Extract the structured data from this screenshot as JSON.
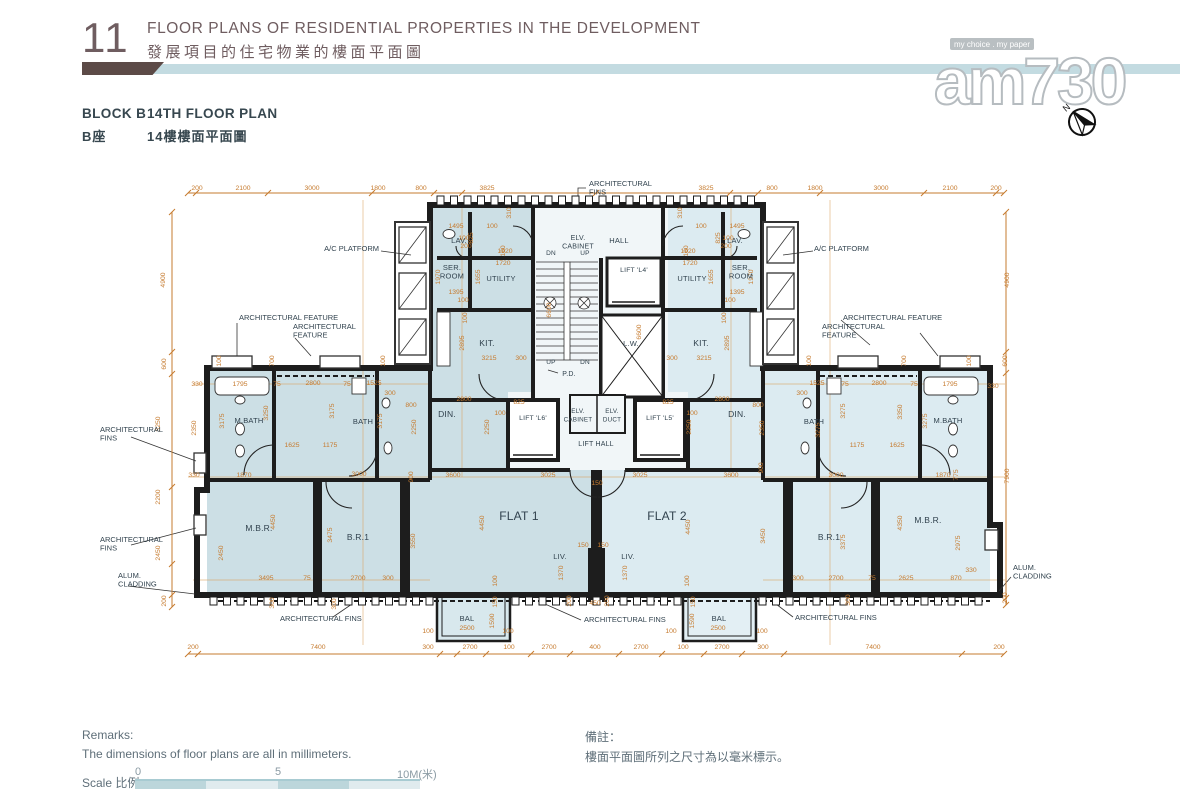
{
  "page": {
    "section_number": "11",
    "title_en": "FLOOR PLANS OF RESIDENTIAL PROPERTIES IN THE DEVELOPMENT",
    "title_zh": "發展項目的住宅物業的樓面平面圖",
    "block_label_en": "BLOCK B",
    "block_label_zh": "B座",
    "plan_label_en": "14TH FLOOR PLAN",
    "plan_label_zh": "14樓樓面平面圖"
  },
  "watermark": {
    "logo_text": "am730",
    "tagline": "my choice . my paper",
    "compass_letter": "N"
  },
  "remarks": {
    "en_title": "Remarks:",
    "en_text": "The dimensions of floor plans are all in millimeters.",
    "zh_title": "備註：",
    "zh_text": "樓面平面圖所列之尺寸為以毫米標示。"
  },
  "scale": {
    "label": "Scale 比例 :",
    "ticks": [
      "0",
      "5",
      "10M(米)"
    ]
  },
  "colors": {
    "dimension_orange": "#c67b2f",
    "wall": "#1d1d1d",
    "flat1_fill": "#ccdfe5",
    "flat2_fill": "#dcebf1",
    "common_fill": "#f1f6f8",
    "header_brown": "#6f5d60",
    "divider_blue": "#c3dbe1",
    "divider_brown": "#5c4a47",
    "label_blue": "#31424e"
  },
  "plan": {
    "flats": [
      "FLAT 1",
      "FLAT 2"
    ],
    "rooms": [
      {
        "t": "LAV.",
        "x": 459,
        "y": 243,
        "fs": 7.5
      },
      {
        "t": "LAV.",
        "x": 735,
        "y": 243,
        "fs": 7.5
      },
      {
        "lines": [
          "SER.",
          "ROOM"
        ],
        "x": 452,
        "y": 270,
        "fs": 7.5
      },
      {
        "lines": [
          "SER.",
          "ROOM"
        ],
        "x": 741,
        "y": 270,
        "fs": 7.5
      },
      {
        "t": "UTILITY",
        "x": 501,
        "y": 281,
        "fs": 7.5
      },
      {
        "t": "UTILITY",
        "x": 692,
        "y": 281,
        "fs": 7.5
      },
      {
        "lines": [
          "ELV.",
          "CABINET"
        ],
        "x": 578,
        "y": 240,
        "fs": 7
      },
      {
        "t": "HALL",
        "x": 619,
        "y": 243,
        "fs": 7.5
      },
      {
        "t": "DN",
        "x": 551,
        "y": 255,
        "fs": 6.5
      },
      {
        "t": "UP",
        "x": 585,
        "y": 255,
        "fs": 6.5
      },
      {
        "t": "UP",
        "x": 551,
        "y": 364,
        "fs": 6.5
      },
      {
        "t": "DN",
        "x": 585,
        "y": 364,
        "fs": 6.5
      },
      {
        "t": "LIFT 'L4'",
        "x": 634,
        "y": 272,
        "fs": 6.8
      },
      {
        "t": "L.W.",
        "x": 631,
        "y": 346,
        "fs": 7.5
      },
      {
        "t": "P.D.",
        "x": 569,
        "y": 376,
        "fs": 7
      },
      {
        "t": "KIT.",
        "x": 487,
        "y": 346
      },
      {
        "t": "KIT.",
        "x": 701,
        "y": 346
      },
      {
        "t": "LIFT 'L6'",
        "x": 533,
        "y": 420,
        "fs": 6.8
      },
      {
        "t": "LIFT 'L5'",
        "x": 660,
        "y": 420,
        "fs": 6.8
      },
      {
        "lines": [
          "ELV.",
          "CABINET"
        ],
        "x": 578,
        "y": 413,
        "fs": 6.3
      },
      {
        "lines": [
          "ELV.",
          "DUCT"
        ],
        "x": 612,
        "y": 413,
        "fs": 6.3
      },
      {
        "t": "LIFT HALL",
        "x": 596,
        "y": 446,
        "fs": 7
      },
      {
        "t": "DIN.",
        "x": 447,
        "y": 417
      },
      {
        "t": "DIN.",
        "x": 737,
        "y": 417
      },
      {
        "t": "M.BATH",
        "x": 249,
        "y": 423,
        "fs": 7.5
      },
      {
        "t": "BATH",
        "x": 363,
        "y": 424,
        "fs": 7.5
      },
      {
        "t": "BATH",
        "x": 814,
        "y": 424,
        "fs": 7.5
      },
      {
        "t": "M.BATH",
        "x": 948,
        "y": 423,
        "fs": 7.5
      },
      {
        "t": "M.B.R.",
        "x": 259,
        "y": 531
      },
      {
        "t": "B.R.1",
        "x": 358,
        "y": 540
      },
      {
        "t": "B.R.1",
        "x": 829,
        "y": 540
      },
      {
        "t": "M.B.R.",
        "x": 928,
        "y": 523
      },
      {
        "t": "FLAT 1",
        "x": 519,
        "y": 520,
        "fs": 12
      },
      {
        "t": "FLAT 2",
        "x": 667,
        "y": 520,
        "fs": 12
      },
      {
        "t": "LIV.",
        "x": 560,
        "y": 559,
        "fs": 7.5
      },
      {
        "t": "LIV.",
        "x": 628,
        "y": 559,
        "fs": 7.5
      },
      {
        "t": "BAL",
        "x": 467,
        "y": 621,
        "fs": 7.5
      },
      {
        "t": "BAL",
        "x": 719,
        "y": 621,
        "fs": 7.5
      }
    ],
    "annotations": [
      {
        "lines": [
          "ARCHITECTURAL",
          "FINS"
        ],
        "x": 589,
        "y": 186,
        "a": "start"
      },
      {
        "t": "A/C PLATFORM",
        "x": 379,
        "y": 251,
        "a": "end"
      },
      {
        "t": "A/C PLATFORM",
        "x": 814,
        "y": 251,
        "a": "start"
      },
      {
        "t": "ARCHITECTURAL FEATURE",
        "x": 239,
        "y": 320,
        "a": "start"
      },
      {
        "lines": [
          "ARCHITECTURAL",
          "FEATURE"
        ],
        "x": 293,
        "y": 329,
        "a": "start"
      },
      {
        "t": "ARCHITECTURAL FEATURE",
        "x": 843,
        "y": 320,
        "a": "start"
      },
      {
        "lines": [
          "ARCHITECTURAL",
          "FEATURE"
        ],
        "x": 822,
        "y": 329,
        "a": "start"
      },
      {
        "lines": [
          "ARCHITECTURAL",
          "FINS"
        ],
        "x": 100,
        "y": 432,
        "a": "start"
      },
      {
        "lines": [
          "ARCHITECTURAL",
          "FINS"
        ],
        "x": 100,
        "y": 542,
        "a": "start"
      },
      {
        "lines": [
          "ALUM.",
          "CLADDING"
        ],
        "x": 118,
        "y": 578,
        "a": "start"
      },
      {
        "lines": [
          "ALUM.",
          "CLADDING"
        ],
        "x": 1013,
        "y": 570,
        "a": "start"
      },
      {
        "t": "ARCHITECTURAL FINS",
        "x": 280,
        "y": 621,
        "a": "start"
      },
      {
        "t": "ARCHITECTURAL FINS",
        "x": 584,
        "y": 622,
        "a": "start"
      },
      {
        "t": "ARCHITECTURAL FINS",
        "x": 795,
        "y": 620,
        "a": "start"
      }
    ],
    "dims_h": [
      [
        200,
        197,
        190
      ],
      [
        2100,
        243,
        190
      ],
      [
        3000,
        312,
        190
      ],
      [
        1800,
        378,
        190
      ],
      [
        800,
        421,
        190
      ],
      [
        3825,
        487,
        190
      ],
      [
        3825,
        706,
        190
      ],
      [
        800,
        772,
        190
      ],
      [
        1800,
        815,
        190
      ],
      [
        3000,
        881,
        190
      ],
      [
        2100,
        950,
        190
      ],
      [
        200,
        996,
        190
      ],
      [
        200,
        193,
        649
      ],
      [
        7400,
        318,
        649
      ],
      [
        300,
        428,
        649
      ],
      [
        2700,
        470,
        649
      ],
      [
        100,
        509,
        649
      ],
      [
        2700,
        549,
        649
      ],
      [
        400,
        595,
        649
      ],
      [
        2700,
        641,
        649
      ],
      [
        100,
        683,
        649
      ],
      [
        2700,
        722,
        649
      ],
      [
        300,
        763,
        649
      ],
      [
        7400,
        873,
        649
      ],
      [
        200,
        999,
        649
      ],
      [
        1495,
        456,
        228
      ],
      [
        100,
        492,
        228
      ],
      [
        1495,
        737,
        228
      ],
      [
        100,
        701,
        228
      ],
      [
        100,
        464,
        240
      ],
      [
        200,
        466,
        248
      ],
      [
        100,
        728,
        240
      ],
      [
        200,
        726,
        248
      ],
      [
        1920,
        505,
        253
      ],
      [
        1720,
        503,
        265
      ],
      [
        1920,
        688,
        253
      ],
      [
        1720,
        690,
        265
      ],
      [
        1395,
        456,
        294
      ],
      [
        100,
        463,
        302
      ],
      [
        1395,
        737,
        294
      ],
      [
        100,
        730,
        302
      ],
      [
        3215,
        489,
        360
      ],
      [
        300,
        521,
        360
      ],
      [
        3215,
        704,
        360
      ],
      [
        300,
        672,
        360
      ],
      [
        330,
        197,
        386
      ],
      [
        1795,
        240,
        386
      ],
      [
        75,
        277,
        386
      ],
      [
        2800,
        313,
        385
      ],
      [
        75,
        347,
        386
      ],
      [
        1525,
        374,
        385
      ],
      [
        300,
        390,
        395
      ],
      [
        300,
        802,
        395
      ],
      [
        1525,
        817,
        385
      ],
      [
        75,
        845,
        386
      ],
      [
        2800,
        879,
        385
      ],
      [
        75,
        914,
        386
      ],
      [
        1795,
        950,
        386
      ],
      [
        330,
        993,
        388
      ],
      [
        800,
        411,
        407
      ],
      [
        2800,
        464,
        401
      ],
      [
        100,
        500,
        415
      ],
      [
        2800,
        722,
        401
      ],
      [
        800,
        758,
        407
      ],
      [
        100,
        692,
        415
      ],
      [
        825,
        519,
        404
      ],
      [
        825,
        668,
        404
      ],
      [
        1625,
        292,
        447
      ],
      [
        1175,
        330,
        447
      ],
      [
        1175,
        857,
        447
      ],
      [
        1625,
        897,
        447
      ],
      [
        330,
        194,
        477
      ],
      [
        1870,
        244,
        477
      ],
      [
        3000,
        359,
        476
      ],
      [
        3600,
        453,
        477
      ],
      [
        3025,
        548,
        477
      ],
      [
        3025,
        640,
        477
      ],
      [
        3600,
        731,
        477
      ],
      [
        3000,
        836,
        477
      ],
      [
        1870,
        943,
        477
      ],
      [
        150,
        583,
        547
      ],
      [
        150,
        603,
        547
      ],
      [
        150,
        597,
        485
      ],
      [
        3495,
        266,
        580
      ],
      [
        75,
        307,
        580
      ],
      [
        2700,
        358,
        580
      ],
      [
        300,
        388,
        580
      ],
      [
        300,
        798,
        580
      ],
      [
        2700,
        836,
        580
      ],
      [
        75,
        872,
        580
      ],
      [
        2625,
        906,
        580
      ],
      [
        870,
        956,
        580
      ],
      [
        330,
        971,
        572
      ],
      [
        100,
        428,
        633
      ],
      [
        2500,
        467,
        630
      ],
      [
        100,
        508,
        633
      ],
      [
        100,
        671,
        633
      ],
      [
        2500,
        718,
        630
      ],
      [
        100,
        762,
        633
      ],
      [
        450,
        595,
        605
      ]
    ],
    "dims_v": [
      [
        4900,
        165,
        280
      ],
      [
        600,
        166,
        364
      ],
      [
        3250,
        160,
        424
      ],
      [
        2200,
        160,
        497
      ],
      [
        2450,
        160,
        553
      ],
      [
        200,
        166,
        601
      ],
      [
        4900,
        1009,
        280
      ],
      [
        600,
        1007,
        361
      ],
      [
        7900,
        1009,
        476
      ],
      [
        200,
        1007,
        598
      ],
      [
        825,
        473,
        238
      ],
      [
        825,
        720,
        238
      ],
      [
        310,
        511,
        213
      ],
      [
        310,
        682,
        213
      ],
      [
        160,
        505,
        251
      ],
      [
        160,
        688,
        251
      ],
      [
        1970,
        440,
        277
      ],
      [
        1970,
        753,
        277
      ],
      [
        1655,
        480,
        277
      ],
      [
        1655,
        713,
        277
      ],
      [
        100,
        467,
        318
      ],
      [
        100,
        726,
        318
      ],
      [
        2895,
        464,
        343
      ],
      [
        2895,
        729,
        343
      ],
      [
        6600,
        551,
        310
      ],
      [
        6600,
        641,
        332
      ],
      [
        700,
        274,
        361
      ],
      [
        700,
        906,
        361
      ],
      [
        100,
        221,
        361
      ],
      [
        100,
        385,
        361
      ],
      [
        100,
        811,
        361
      ],
      [
        100,
        971,
        361
      ],
      [
        2350,
        196,
        428
      ],
      [
        3250,
        268,
        413
      ],
      [
        3175,
        224,
        421
      ],
      [
        3175,
        334,
        411
      ],
      [
        3175,
        382,
        421
      ],
      [
        3275,
        820,
        430
      ],
      [
        3275,
        845,
        411
      ],
      [
        3350,
        902,
        412
      ],
      [
        3275,
        927,
        421
      ],
      [
        2250,
        416,
        427
      ],
      [
        2250,
        489,
        427
      ],
      [
        2250,
        691,
        427
      ],
      [
        2350,
        764,
        428
      ],
      [
        900,
        413,
        477
      ],
      [
        900,
        763,
        468
      ],
      [
        775,
        958,
        475
      ],
      [
        2450,
        223,
        553
      ],
      [
        4450,
        275,
        522
      ],
      [
        3475,
        332,
        535
      ],
      [
        3550,
        415,
        541
      ],
      [
        4450,
        484,
        523
      ],
      [
        4450,
        690,
        527
      ],
      [
        3450,
        765,
        536
      ],
      [
        3375,
        845,
        542
      ],
      [
        4350,
        902,
        523
      ],
      [
        2975,
        960,
        543
      ],
      [
        1590,
        494,
        621
      ],
      [
        1590,
        694,
        621
      ],
      [
        150,
        497,
        602
      ],
      [
        150,
        695,
        602
      ],
      [
        100,
        497,
        581
      ],
      [
        100,
        689,
        581
      ],
      [
        1370,
        563,
        573
      ],
      [
        1370,
        627,
        573
      ],
      [
        200,
        571,
        601
      ],
      [
        200,
        609,
        601
      ],
      [
        300,
        274,
        603
      ],
      [
        300,
        336,
        604
      ],
      [
        300,
        850,
        600
      ]
    ]
  }
}
